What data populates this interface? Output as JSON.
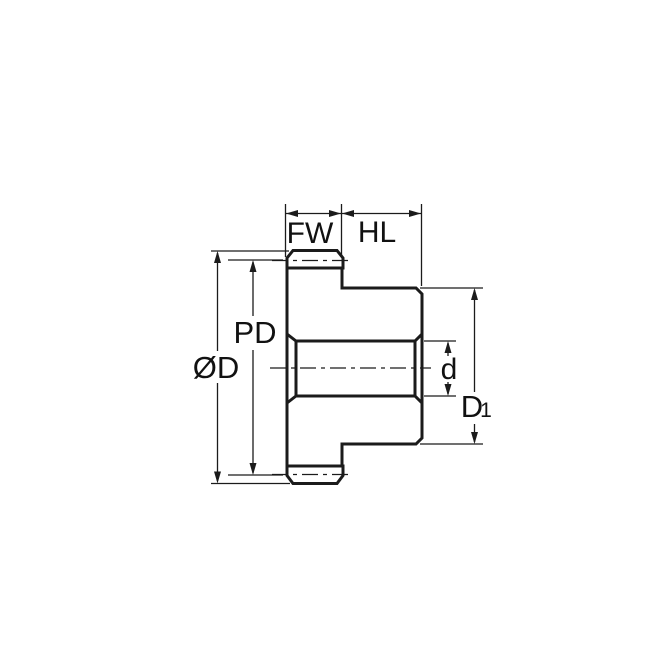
{
  "drawing": {
    "labels": {
      "face_width": "FW",
      "hub_length": "HL",
      "outside_diameter": "ØD",
      "pitch_diameter": "PD",
      "bore_diameter": "d",
      "hub_diameter_main": "D",
      "hub_diameter_sub": "1"
    },
    "colors": {
      "part_fill": "#C5E6F8",
      "line": "#1B1B1B",
      "background": "#FFFFFF"
    }
  }
}
